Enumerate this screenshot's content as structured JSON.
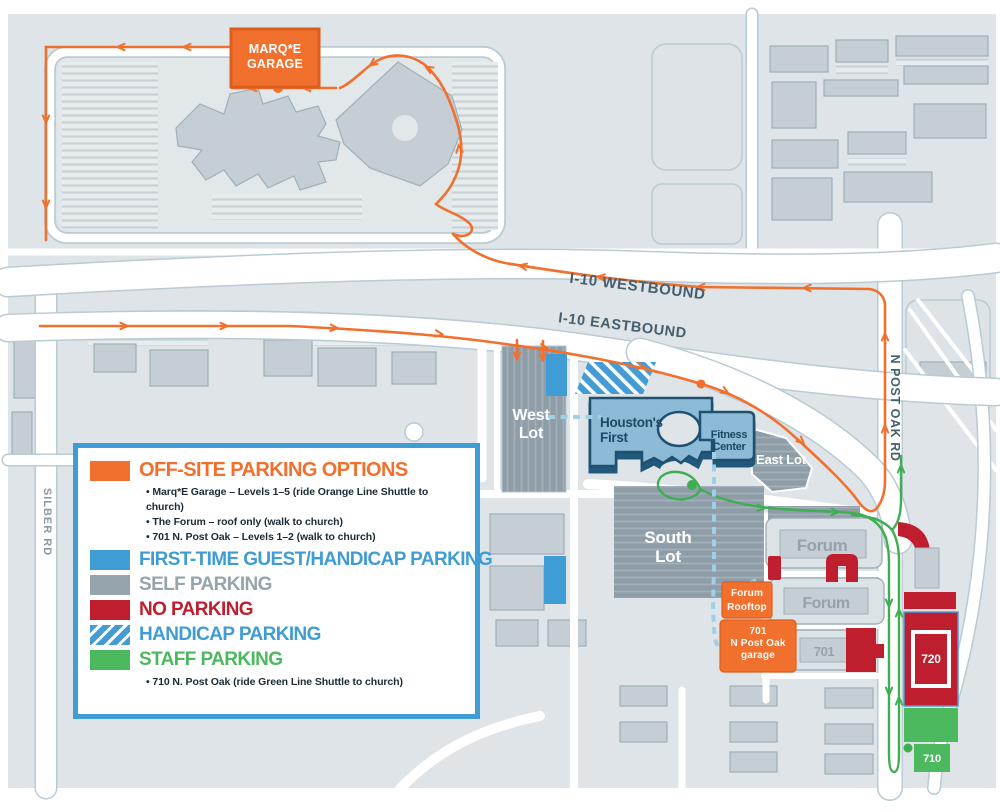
{
  "colors": {
    "orange": "#F1702D",
    "blue": "#3F9CD4",
    "gray": "#95A4AD",
    "red": "#BF1E2E",
    "green": "#4DB95F",
    "church_fill": "#8CBAD7",
    "church_outline": "#1D516F",
    "background": "#DEE4E7",
    "road_label": "#44606E"
  },
  "legend": {
    "offsite_title": "OFF-SITE PARKING OPTIONS",
    "offsite_bullets": [
      "• Marq*E Garage – Levels 1–5 (ride Orange Line Shuttle to church)",
      "• The Forum – roof only (walk to church)",
      "• 701 N. Post Oak – Levels 1–2 (walk to church)"
    ],
    "first_time": "FIRST-TIME GUEST/HANDICAP PARKING",
    "self_parking": "SELF PARKING",
    "no_parking": "NO PARKING",
    "handicap": "HANDICAP PARKING",
    "staff": "STAFF PARKING",
    "staff_bullet": "• 710 N. Post Oak (ride Green Line Shuttle to church)"
  },
  "map": {
    "marqe_garage": {
      "l1": "MARQ*E",
      "l2": "GARAGE"
    },
    "forum_rooftop": {
      "l1": "Forum",
      "l2": "Rooftop"
    },
    "garage_701": {
      "l1": "701",
      "l2": "N Post Oak",
      "l3": "garage"
    },
    "west_lot": {
      "l1": "West",
      "l2": "Lot"
    },
    "south_lot": {
      "l1": "South",
      "l2": "Lot"
    },
    "east_lot": "East Lot",
    "church": {
      "l1": "Houston's",
      "l2": "First"
    },
    "fitness": {
      "l1": "Fitness",
      "l2": "Center"
    },
    "forum_upper": "Forum",
    "forum_lower": "Forum",
    "bldg_701": "701",
    "bldg_720": "720",
    "bldg_710": "710",
    "roads": {
      "i10_west": "I-10 WESTBOUND",
      "i10_east": "I-10 EASTBOUND",
      "silber": "SILBER RD",
      "post_oak": "N POST OAK RD"
    }
  }
}
